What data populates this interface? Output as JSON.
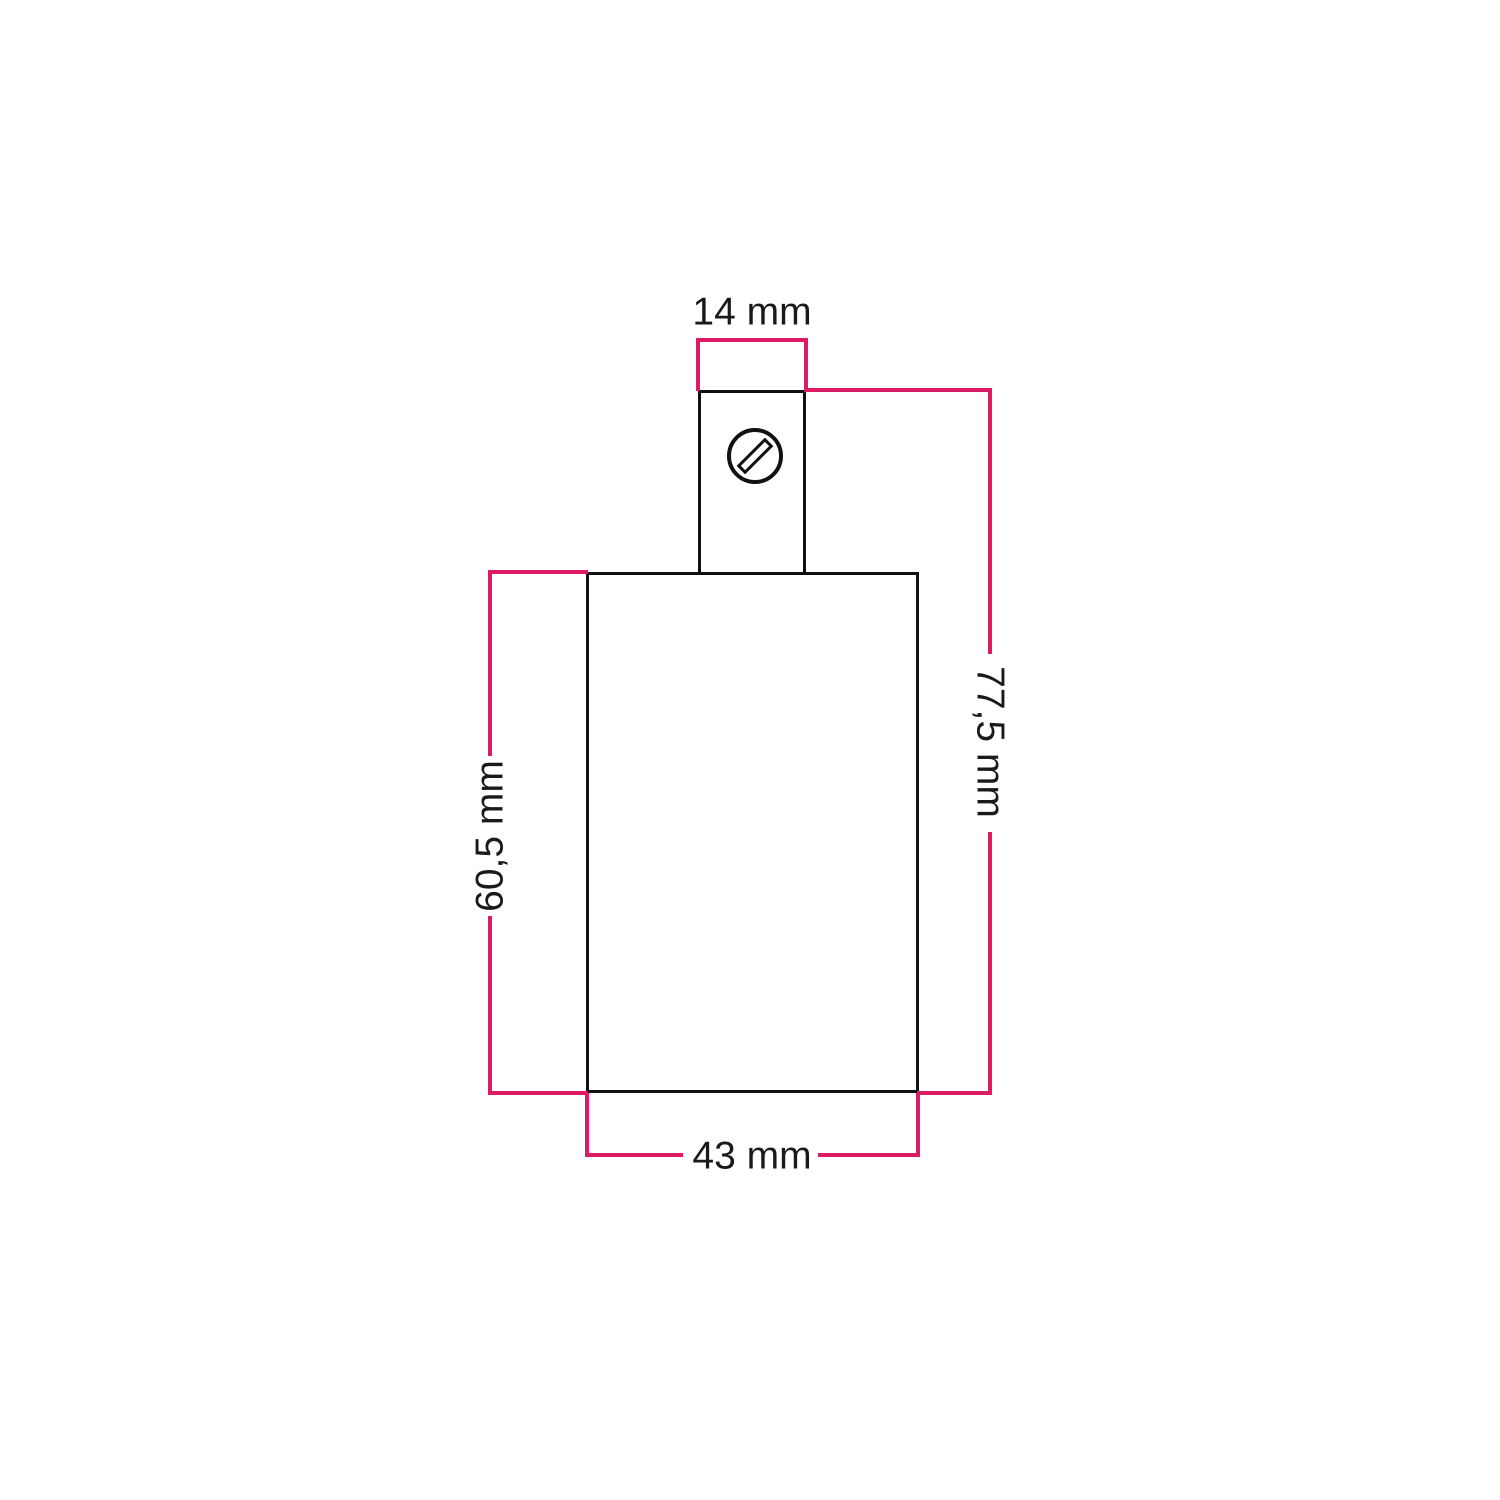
{
  "diagram": {
    "labels": {
      "top_width": "14 mm",
      "total_height": "77,5 mm",
      "body_height": "60,5 mm",
      "body_width": "43 mm"
    },
    "icons": {
      "screw": "slotted-screw-head-icon"
    },
    "colors": {
      "dimension_line": "#dd1a64",
      "outline": "#111111",
      "text": "#1a1a1a",
      "background": "#ffffff"
    }
  }
}
